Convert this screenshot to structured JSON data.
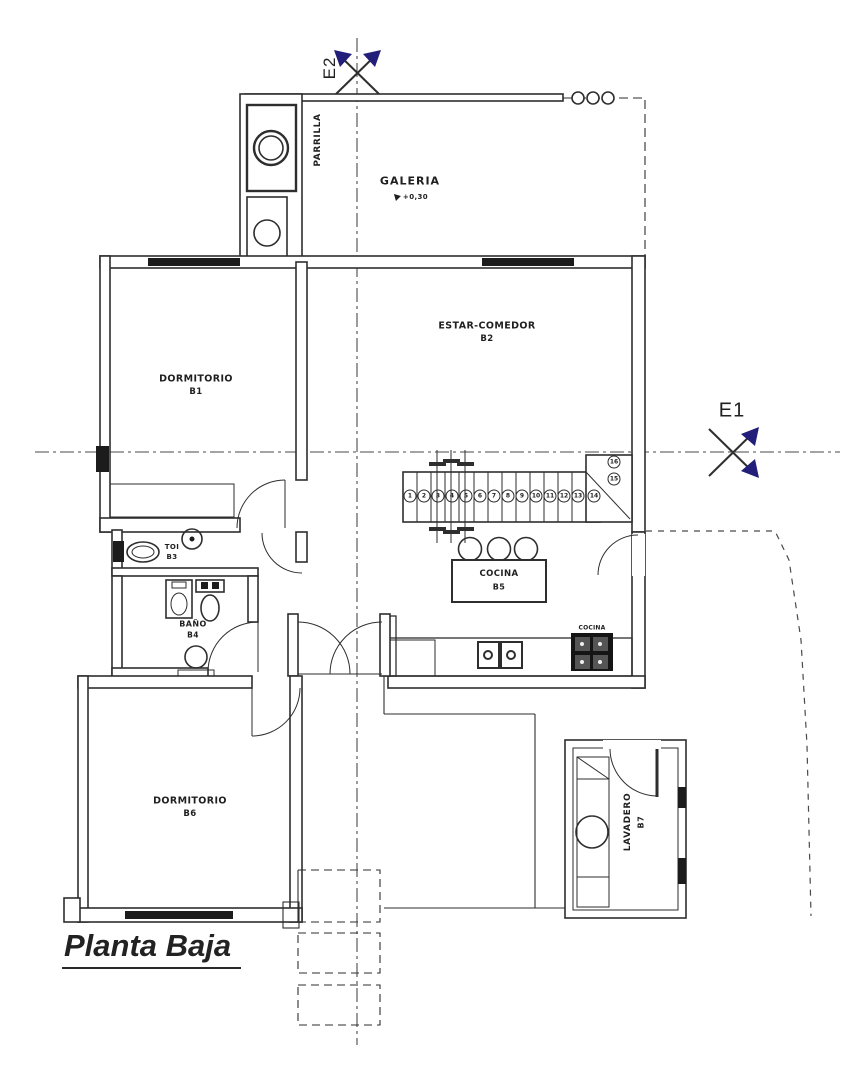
{
  "title": "Planta Baja",
  "colors": {
    "line": "#2e2e2e",
    "accent_arrow": "#221f7a",
    "background": "#ffffff"
  },
  "markers": {
    "e1": "E1",
    "e2": "E2"
  },
  "rooms": {
    "galeria": {
      "name": "GALERIA",
      "level": "+0,30"
    },
    "parrilla": {
      "name": "PARRILLA"
    },
    "estar": {
      "name": "ESTAR-COMEDOR",
      "code": "B2"
    },
    "dorm1": {
      "name": "DORMITORIO",
      "code": "B1"
    },
    "toi": {
      "name": "TOI",
      "code": "B3"
    },
    "bano": {
      "name": "BAÑO",
      "code": "B4"
    },
    "cocina": {
      "name": "COCINA",
      "code": "B5"
    },
    "cocina_stove": {
      "name": "COCINA"
    },
    "dorm2": {
      "name": "DORMITORIO",
      "code": "B6"
    },
    "lavadero": {
      "name": "LAVADERO",
      "code": "B7"
    }
  },
  "stairs": {
    "steps": [
      "1",
      "2",
      "3",
      "4",
      "5",
      "6",
      "7",
      "8",
      "9",
      "10",
      "11",
      "12",
      "13",
      "14",
      "15",
      "16"
    ]
  }
}
